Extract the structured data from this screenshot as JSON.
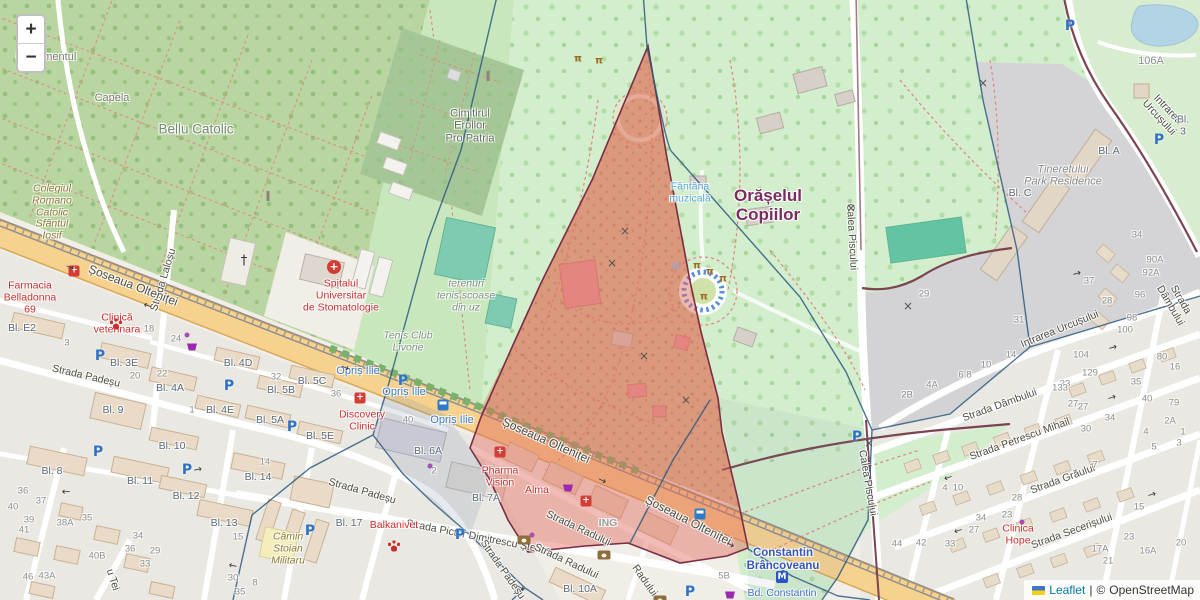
{
  "controls": {
    "zoom_in": "+",
    "zoom_out": "−"
  },
  "attribution": {
    "flag": "ukraine-flag",
    "leaflet": "Leaflet",
    "separator": "|",
    "copyright": "©",
    "osm": "OpenStreetMap"
  },
  "colors": {
    "land": "#f1eee8",
    "cemetery_green": "#b9d6a2",
    "park_green": "#d2eecd",
    "scrub_tan": "#d6c096",
    "road_yellow": "#f6d28e",
    "pitch_teal": "#7fcbb1",
    "water": "#b3d4e5",
    "overlay_red_border": "#7a2d45",
    "overlay_red_fill": "rgba(224,106,94,0.45)",
    "overlay_blue_line": "#2e5a80",
    "poi_red": "#cc2f2f",
    "bus_blue": "#3d7dc9"
  },
  "map_labels": [
    {
      "t": "Capela",
      "x": 112,
      "y": 98,
      "c": "place"
    },
    {
      "t": "Bellu Catolic",
      "x": 196,
      "y": 129,
      "c": "place-lg"
    },
    {
      "t": "Monumentul",
      "x": 46,
      "y": 57,
      "c": "place"
    },
    {
      "t": "or",
      "x": 40,
      "y": 68,
      "c": "place"
    },
    {
      "t": "Colegiul\nRomano\nCatolic\nSfântul\nIosif",
      "x": 52,
      "y": 213,
      "c": "olive"
    },
    {
      "t": "Cimitirul\nEroilor\nPro Patria",
      "x": 470,
      "y": 126,
      "c": "cem"
    },
    {
      "t": "Orășelul\nCopiilor",
      "x": 768,
      "y": 205,
      "c": "park-name"
    },
    {
      "t": "Fântâna\nmuzicală",
      "x": 690,
      "y": 193,
      "c": "water"
    },
    {
      "t": "Calea Piscului",
      "x": 851,
      "y": 237,
      "r": 87,
      "c": "street"
    },
    {
      "t": "Calea Piscului",
      "x": 867,
      "y": 483,
      "r": 80,
      "c": "street"
    },
    {
      "t": "Intrarea Urcușului",
      "x": 1163,
      "y": 114,
      "r": 47,
      "c": "street"
    },
    {
      "t": "Intrarea Urcușului",
      "x": 1060,
      "y": 330,
      "r": -22,
      "c": "street"
    },
    {
      "t": "Strada Dâmbului",
      "x": 1175,
      "y": 303,
      "r": 60,
      "c": "street"
    },
    {
      "t": "Strada Dâmbului",
      "x": 1000,
      "y": 406,
      "r": -20,
      "c": "street"
    },
    {
      "t": "Strada Petrescu Mihail",
      "x": 1020,
      "y": 440,
      "r": -20,
      "c": "street"
    },
    {
      "t": "Strada Grăului",
      "x": 1063,
      "y": 480,
      "r": -20,
      "c": "street"
    },
    {
      "t": "Strada Secerișului",
      "x": 1072,
      "y": 532,
      "r": -20,
      "c": "street"
    },
    {
      "t": "Strada Pictor Dimitrescu Ștefan",
      "x": 478,
      "y": 538,
      "r": 11,
      "c": "street"
    },
    {
      "t": "Strada Padeșu",
      "x": 86,
      "y": 377,
      "r": 13,
      "c": "street"
    },
    {
      "t": "Strada Padeșu",
      "x": 362,
      "y": 492,
      "r": 16,
      "c": "street"
    },
    {
      "t": "Strada Padeșu",
      "x": 502,
      "y": 570,
      "r": 55,
      "c": "street"
    },
    {
      "t": "u Tei",
      "x": 112,
      "y": 580,
      "r": 72,
      "c": "street"
    },
    {
      "t": "Strada Laloșu",
      "x": 164,
      "y": 280,
      "r": -73,
      "c": "street"
    },
    {
      "t": "Strada Radului",
      "x": 578,
      "y": 529,
      "r": 25,
      "c": "street"
    },
    {
      "t": "Strada Radului",
      "x": 566,
      "y": 562,
      "r": 25,
      "c": "street"
    },
    {
      "t": "Radului",
      "x": 644,
      "y": 581,
      "r": 55,
      "c": "street"
    },
    {
      "t": "Șoseaua Olteniței",
      "x": 133,
      "y": 286,
      "r": 21,
      "c": "street-lg"
    },
    {
      "t": "Șoseaua Olteniței",
      "x": 546,
      "y": 441,
      "r": 24,
      "c": "street-lg"
    },
    {
      "t": "Șoseaua Olteniței",
      "x": 688,
      "y": 521,
      "r": 27,
      "c": "street-lg"
    },
    {
      "t": "Opriș Ilie",
      "x": 358,
      "y": 371,
      "c": "bus"
    },
    {
      "t": "Opriș Ilie",
      "x": 404,
      "y": 392,
      "c": "bus"
    },
    {
      "t": "Opriș Ilie",
      "x": 452,
      "y": 420,
      "c": "bus"
    },
    {
      "t": "Tenis Club\nLivorie",
      "x": 408,
      "y": 342,
      "c": "italic"
    },
    {
      "t": "terenuri\ntenis scoase\ndin uz",
      "x": 466,
      "y": 296,
      "c": "italic"
    },
    {
      "t": "Tineretului\nPark Residence",
      "x": 1063,
      "y": 176,
      "c": "italic-gray"
    },
    {
      "t": "Câmin\nStoian\nMilitaru",
      "x": 288,
      "y": 549,
      "c": "olive"
    },
    {
      "t": "Constantin\nBrâncoveanu",
      "x": 783,
      "y": 560,
      "c": "metro"
    },
    {
      "t": "Bd. Constantin",
      "x": 782,
      "y": 594,
      "c": "bd"
    },
    {
      "t": "Clinica\nHope",
      "x": 1018,
      "y": 535,
      "c": "poi"
    },
    {
      "t": "Discovery\nClinic",
      "x": 362,
      "y": 421,
      "c": "poi"
    },
    {
      "t": "Farmacia\nBelladonna\n69",
      "x": 30,
      "y": 298,
      "c": "poi"
    },
    {
      "t": "Clinică\nveterinara",
      "x": 117,
      "y": 324,
      "c": "poi"
    },
    {
      "t": "Spitalul\nUniversitar\nde Stomatologie",
      "x": 341,
      "y": 296,
      "c": "poi"
    },
    {
      "t": "Pharma\nVision",
      "x": 500,
      "y": 477,
      "c": "poi"
    },
    {
      "t": "Alma",
      "x": 537,
      "y": 491,
      "c": "poi"
    },
    {
      "t": "Balkanivet",
      "x": 394,
      "y": 526,
      "c": "poi"
    },
    {
      "t": "ING",
      "x": 608,
      "y": 524,
      "c": "gray-poi"
    },
    {
      "t": "106A",
      "x": 1151,
      "y": 61,
      "c": "num-lg"
    },
    {
      "t": "Bl. E2",
      "x": 22,
      "y": 329,
      "c": "block"
    },
    {
      "t": "Bl. 3E",
      "x": 124,
      "y": 364,
      "c": "block"
    },
    {
      "t": "Bl. 4A",
      "x": 170,
      "y": 389,
      "c": "block"
    },
    {
      "t": "Bl. 4D",
      "x": 238,
      "y": 364,
      "c": "block"
    },
    {
      "t": "Bl. 5C",
      "x": 312,
      "y": 382,
      "c": "block"
    },
    {
      "t": "Bl. 5B",
      "x": 281,
      "y": 391,
      "c": "block"
    },
    {
      "t": "Bl. 4E",
      "x": 220,
      "y": 411,
      "c": "block"
    },
    {
      "t": "Bl. 5A",
      "x": 270,
      "y": 421,
      "c": "block"
    },
    {
      "t": "Bl. 5E",
      "x": 320,
      "y": 437,
      "c": "block"
    },
    {
      "t": "Bl. 6A",
      "x": 428,
      "y": 452,
      "c": "block"
    },
    {
      "t": "Bl. 7A",
      "x": 486,
      "y": 499,
      "c": "block"
    },
    {
      "t": "Bl. 9",
      "x": 113,
      "y": 411,
      "c": "block"
    },
    {
      "t": "Bl. 8",
      "x": 52,
      "y": 472,
      "c": "block"
    },
    {
      "t": "Bl. 10",
      "x": 172,
      "y": 447,
      "c": "block"
    },
    {
      "t": "Bl. 11",
      "x": 140,
      "y": 482,
      "c": "block"
    },
    {
      "t": "Bl. 12",
      "x": 186,
      "y": 497,
      "c": "block"
    },
    {
      "t": "Bl. 13",
      "x": 224,
      "y": 524,
      "c": "block"
    },
    {
      "t": "Bl. 14",
      "x": 258,
      "y": 478,
      "c": "block"
    },
    {
      "t": "Bl. 17",
      "x": 349,
      "y": 524,
      "c": "block"
    },
    {
      "t": "Bl. 10A",
      "x": 580,
      "y": 590,
      "c": "block"
    },
    {
      "t": "Bl. A",
      "x": 1109,
      "y": 152,
      "c": "block"
    },
    {
      "t": "Bl. C",
      "x": 1020,
      "y": 194,
      "c": "block"
    },
    {
      "t": "Bl. 3",
      "x": 1183,
      "y": 126,
      "c": "block"
    },
    {
      "t": "14",
      "x": 265,
      "y": 463,
      "c": "num"
    },
    {
      "t": "15",
      "x": 238,
      "y": 538,
      "c": "num"
    },
    {
      "t": "18",
      "x": 149,
      "y": 330,
      "c": "num"
    },
    {
      "t": "24",
      "x": 176,
      "y": 340,
      "c": "num"
    },
    {
      "t": "20",
      "x": 135,
      "y": 377,
      "c": "num"
    },
    {
      "t": "22",
      "x": 162,
      "y": 375,
      "c": "num"
    },
    {
      "t": "3",
      "x": 67,
      "y": 344,
      "c": "num"
    },
    {
      "t": "40",
      "x": 408,
      "y": 421,
      "c": "num"
    },
    {
      "t": "2",
      "x": 434,
      "y": 472,
      "c": "num"
    },
    {
      "t": "36",
      "x": 336,
      "y": 395,
      "c": "num"
    },
    {
      "t": "32",
      "x": 276,
      "y": 378,
      "c": "num"
    },
    {
      "t": "1",
      "x": 192,
      "y": 411,
      "c": "num"
    },
    {
      "t": "34",
      "x": 1137,
      "y": 236,
      "c": "num"
    },
    {
      "t": "90A",
      "x": 1155,
      "y": 261,
      "c": "num"
    },
    {
      "t": "92A",
      "x": 1151,
      "y": 274,
      "c": "num"
    },
    {
      "t": "96",
      "x": 1140,
      "y": 296,
      "c": "num"
    },
    {
      "t": "98",
      "x": 1132,
      "y": 319,
      "c": "num"
    },
    {
      "t": "100",
      "x": 1125,
      "y": 331,
      "c": "num"
    },
    {
      "t": "104",
      "x": 1081,
      "y": 356,
      "c": "num"
    },
    {
      "t": "129",
      "x": 1090,
      "y": 374,
      "c": "num"
    },
    {
      "t": "37",
      "x": 1089,
      "y": 282,
      "c": "num"
    },
    {
      "t": "28",
      "x": 1107,
      "y": 302,
      "c": "num"
    },
    {
      "t": "33",
      "x": 1065,
      "y": 385,
      "c": "num"
    },
    {
      "t": "27",
      "x": 1073,
      "y": 405,
      "c": "num"
    },
    {
      "t": "35",
      "x": 1136,
      "y": 383,
      "c": "num"
    },
    {
      "t": "40",
      "x": 1147,
      "y": 400,
      "c": "num"
    },
    {
      "t": "80",
      "x": 1162,
      "y": 358,
      "c": "num"
    },
    {
      "t": "16",
      "x": 1175,
      "y": 368,
      "c": "num"
    },
    {
      "t": "29",
      "x": 924,
      "y": 295,
      "c": "num"
    },
    {
      "t": "31",
      "x": 1019,
      "y": 321,
      "c": "num"
    },
    {
      "t": "14",
      "x": 1011,
      "y": 356,
      "c": "num"
    },
    {
      "t": "10",
      "x": 986,
      "y": 366,
      "c": "num"
    },
    {
      "t": "6 8",
      "x": 965,
      "y": 376,
      "c": "num"
    },
    {
      "t": "4A",
      "x": 932,
      "y": 386,
      "c": "num"
    },
    {
      "t": "2B",
      "x": 907,
      "y": 396,
      "c": "num"
    },
    {
      "t": "133",
      "x": 1060,
      "y": 389,
      "c": "num"
    },
    {
      "t": "27",
      "x": 1083,
      "y": 408,
      "c": "num"
    },
    {
      "t": "79",
      "x": 1174,
      "y": 404,
      "c": "num"
    },
    {
      "t": "34",
      "x": 1110,
      "y": 419,
      "c": "num"
    },
    {
      "t": "30",
      "x": 1086,
      "y": 430,
      "c": "num"
    },
    {
      "t": "2A",
      "x": 1170,
      "y": 422,
      "c": "num"
    },
    {
      "t": "4",
      "x": 1146,
      "y": 433,
      "c": "num"
    },
    {
      "t": "1",
      "x": 1183,
      "y": 433,
      "c": "num"
    },
    {
      "t": "5",
      "x": 1154,
      "y": 448,
      "c": "num"
    },
    {
      "t": "3",
      "x": 1179,
      "y": 444,
      "c": "num"
    },
    {
      "t": "7",
      "x": 1095,
      "y": 466,
      "c": "num"
    },
    {
      "t": "10",
      "x": 958,
      "y": 489,
      "c": "num"
    },
    {
      "t": "4",
      "x": 945,
      "y": 489,
      "c": "num"
    },
    {
      "t": "28",
      "x": 1017,
      "y": 499,
      "c": "num"
    },
    {
      "t": "23",
      "x": 1007,
      "y": 516,
      "c": "num"
    },
    {
      "t": "34",
      "x": 981,
      "y": 519,
      "c": "num"
    },
    {
      "t": "27",
      "x": 974,
      "y": 531,
      "c": "num"
    },
    {
      "t": "33",
      "x": 950,
      "y": 545,
      "c": "num"
    },
    {
      "t": "44",
      "x": 897,
      "y": 545,
      "c": "num"
    },
    {
      "t": "42",
      "x": 921,
      "y": 544,
      "c": "num"
    },
    {
      "t": "15",
      "x": 1139,
      "y": 508,
      "c": "num"
    },
    {
      "t": "23",
      "x": 1129,
      "y": 538,
      "c": "num"
    },
    {
      "t": "20",
      "x": 1181,
      "y": 544,
      "c": "num"
    },
    {
      "t": "21",
      "x": 1108,
      "y": 562,
      "c": "num"
    },
    {
      "t": "17A",
      "x": 1100,
      "y": 550,
      "c": "num"
    },
    {
      "t": "16A",
      "x": 1148,
      "y": 552,
      "c": "num"
    },
    {
      "t": "5B",
      "x": 724,
      "y": 577,
      "c": "num"
    },
    {
      "t": "36",
      "x": 23,
      "y": 492,
      "c": "num"
    },
    {
      "t": "37",
      "x": 41,
      "y": 502,
      "c": "num"
    },
    {
      "t": "40",
      "x": 13,
      "y": 508,
      "c": "num"
    },
    {
      "t": "39",
      "x": 29,
      "y": 521,
      "c": "num"
    },
    {
      "t": "41",
      "x": 24,
      "y": 531,
      "c": "num"
    },
    {
      "t": "38A",
      "x": 65,
      "y": 524,
      "c": "num"
    },
    {
      "t": "35",
      "x": 87,
      "y": 519,
      "c": "num"
    },
    {
      "t": "34",
      "x": 138,
      "y": 537,
      "c": "num"
    },
    {
      "t": "36",
      "x": 130,
      "y": 550,
      "c": "num"
    },
    {
      "t": "40B",
      "x": 97,
      "y": 557,
      "c": "num"
    },
    {
      "t": "29",
      "x": 155,
      "y": 552,
      "c": "num"
    },
    {
      "t": "33",
      "x": 145,
      "y": 565,
      "c": "num"
    },
    {
      "t": "46",
      "x": 28,
      "y": 578,
      "c": "num"
    },
    {
      "t": "43A",
      "x": 47,
      "y": 577,
      "c": "num"
    },
    {
      "t": "30",
      "x": 233,
      "y": 579,
      "c": "num"
    },
    {
      "t": "8",
      "x": 255,
      "y": 584,
      "c": "num"
    },
    {
      "t": "35",
      "x": 240,
      "y": 593,
      "c": "num"
    }
  ],
  "map_icons": [
    {
      "k": "P",
      "x": 100,
      "y": 356
    },
    {
      "k": "P",
      "x": 229,
      "y": 386
    },
    {
      "k": "P",
      "x": 292,
      "y": 427
    },
    {
      "k": "P",
      "x": 403,
      "y": 381
    },
    {
      "k": "P",
      "x": 460,
      "y": 535
    },
    {
      "k": "P",
      "x": 690,
      "y": 592
    },
    {
      "k": "P",
      "x": 857,
      "y": 437
    },
    {
      "k": "P",
      "x": 1070,
      "y": 26
    },
    {
      "k": "P",
      "x": 1159,
      "y": 140
    },
    {
      "k": "P",
      "x": 98,
      "y": 452
    },
    {
      "k": "P",
      "x": 187,
      "y": 470
    },
    {
      "k": "P",
      "x": 310,
      "y": 531
    },
    {
      "k": "bus",
      "x": 443,
      "y": 405
    },
    {
      "k": "bus",
      "x": 700,
      "y": 503
    },
    {
      "k": "hospital",
      "x": 334,
      "y": 267
    },
    {
      "k": "redcross",
      "x": 360,
      "y": 398
    },
    {
      "k": "redcross",
      "x": 500,
      "y": 452
    },
    {
      "k": "redcross",
      "x": 586,
      "y": 501
    },
    {
      "k": "redcross",
      "x": 74,
      "y": 271
    },
    {
      "k": "paw",
      "x": 116,
      "y": 302
    },
    {
      "k": "paw",
      "x": 394,
      "y": 513
    },
    {
      "k": "cart",
      "x": 192,
      "y": 347
    },
    {
      "k": "cart",
      "x": 568,
      "y": 488
    },
    {
      "k": "cart",
      "x": 730,
      "y": 595
    },
    {
      "k": "money",
      "x": 604,
      "y": 511
    },
    {
      "k": "money",
      "x": 660,
      "y": 547
    },
    {
      "k": "money",
      "x": 688,
      "y": 560
    },
    {
      "k": "money",
      "x": 524,
      "y": 469
    },
    {
      "k": "metro",
      "x": 782,
      "y": 577
    },
    {
      "k": "dagger",
      "x": 244,
      "y": 261
    },
    {
      "k": "pillar",
      "x": 268,
      "y": 196
    },
    {
      "k": "pillar",
      "x": 488,
      "y": 76
    },
    {
      "k": "gate",
      "x": 578,
      "y": 59
    },
    {
      "k": "gate",
      "x": 599,
      "y": 61
    },
    {
      "k": "gate",
      "x": 697,
      "y": 266
    },
    {
      "k": "gate",
      "x": 710,
      "y": 272
    },
    {
      "k": "gate",
      "x": 723,
      "y": 279
    },
    {
      "k": "gate",
      "x": 704,
      "y": 297
    },
    {
      "k": "xmark",
      "x": 625,
      "y": 231
    },
    {
      "k": "xmark",
      "x": 612,
      "y": 263
    },
    {
      "k": "xmark",
      "x": 644,
      "y": 356
    },
    {
      "k": "xmark",
      "x": 686,
      "y": 400
    },
    {
      "k": "xmark",
      "x": 908,
      "y": 306
    },
    {
      "k": "xmark",
      "x": 983,
      "y": 83
    },
    {
      "k": "xmark",
      "x": 851,
      "y": 208
    },
    {
      "k": "xmark",
      "x": 869,
      "y": 443
    },
    {
      "k": "dot",
      "x": 187,
      "y": 335
    },
    {
      "k": "dot",
      "x": 532,
      "y": 535
    },
    {
      "k": "dot",
      "x": 1022,
      "y": 522
    },
    {
      "k": "dot",
      "x": 430,
      "y": 466
    },
    {
      "k": "arrow",
      "x": 70,
      "y": 268,
      "r": 20
    },
    {
      "k": "arrow",
      "x": 345,
      "y": 368,
      "r": 21
    },
    {
      "k": "arrow",
      "x": 602,
      "y": 481,
      "r": 25
    },
    {
      "k": "arrow",
      "x": 730,
      "y": 545,
      "r": 27
    },
    {
      "k": "arrow",
      "x": 148,
      "y": 305,
      "r": 200
    },
    {
      "k": "arrow",
      "x": 66,
      "y": 491,
      "r": 178
    },
    {
      "k": "arrow",
      "x": 198,
      "y": 470,
      "r": -12
    },
    {
      "k": "arrow",
      "x": 233,
      "y": 565,
      "r": 192
    },
    {
      "k": "arrow",
      "x": 948,
      "y": 477,
      "r": 163
    },
    {
      "k": "arrow",
      "x": 1112,
      "y": 398,
      "r": -17
    },
    {
      "k": "arrow",
      "x": 1152,
      "y": 495,
      "r": -17
    },
    {
      "k": "arrow",
      "x": 958,
      "y": 530,
      "r": 163
    },
    {
      "k": "arrow",
      "x": 1077,
      "y": 274,
      "r": -15
    },
    {
      "k": "arrow",
      "x": 1113,
      "y": 348,
      "r": -15
    },
    {
      "k": "arrow",
      "x": 520,
      "y": 588,
      "r": 30
    }
  ]
}
